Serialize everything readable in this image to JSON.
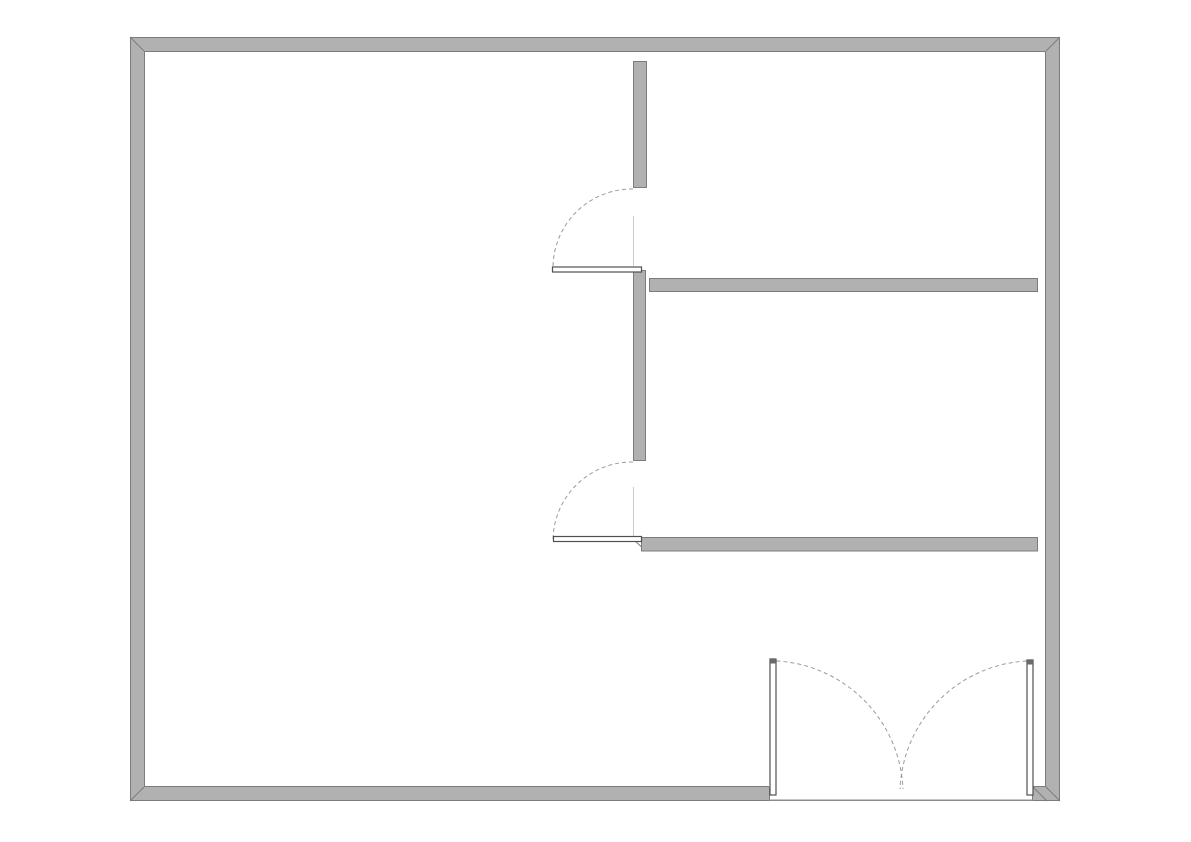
{
  "meta": {
    "canvas": {
      "width": 1191,
      "height": 842
    },
    "background": "#ffffff"
  },
  "palette": {
    "wall_fill": "#b1b1b1",
    "wall_outline": "#7c7c7c",
    "door_leaf_fill": "#ffffff",
    "door_leaf_stroke": "#4f4f4f",
    "door_leaf_cap": "#6a6a6a",
    "swing_arc": "#9b9b9b",
    "axis_line": "#cacaca",
    "threshold": "#8c8c8c"
  },
  "plan": {
    "layers": [
      {
        "group": "outer-wall-fills",
        "shape": "rect",
        "crisp": true,
        "style": {
          "fill": "wall_fill"
        },
        "items": [
          {
            "name": "outer-wall-top",
            "x": 130,
            "y": 37,
            "w": 930,
            "h": 14
          },
          {
            "name": "outer-wall-left",
            "x": 130,
            "y": 37,
            "w": 14,
            "h": 764
          },
          {
            "name": "outer-wall-right",
            "x": 1046,
            "y": 37,
            "w": 14,
            "h": 764
          },
          {
            "name": "outer-wall-bottom-left",
            "x": 130,
            "y": 787,
            "w": 639,
            "h": 14
          },
          {
            "name": "outer-wall-bottom-right",
            "x": 1033,
            "y": 787,
            "w": 27,
            "h": 14
          }
        ]
      },
      {
        "group": "outer-wall-outline",
        "shape": "rect",
        "crisp": true,
        "style": {
          "stroke": "wall_outline",
          "width": 1
        },
        "items": [
          {
            "name": "outer-wall-outer-contour",
            "x": 130.5,
            "y": 37.5,
            "w": 929,
            "h": 763
          }
        ]
      },
      {
        "group": "outer-wall-inner-edges",
        "shape": "line",
        "crisp": true,
        "style": {
          "stroke": "wall_outline",
          "width": 1
        },
        "items": [
          {
            "name": "inner-edge-top",
            "x1": 144,
            "y1": 51.5,
            "x2": 1046,
            "y2": 51.5
          },
          {
            "name": "inner-edge-left",
            "x1": 144.5,
            "y1": 51,
            "x2": 144.5,
            "y2": 787
          },
          {
            "name": "inner-edge-right",
            "x1": 1045.5,
            "y1": 51,
            "x2": 1045.5,
            "y2": 787
          },
          {
            "name": "inner-edge-bottom-left",
            "x1": 144,
            "y1": 786.5,
            "x2": 769,
            "y2": 786.5
          },
          {
            "name": "inner-edge-bottom-right",
            "x1": 1033,
            "y1": 786.5,
            "x2": 1046,
            "y2": 786.5
          },
          {
            "name": "entry-jamb-left",
            "x1": 769.5,
            "y1": 787,
            "x2": 769.5,
            "y2": 800
          },
          {
            "name": "entry-jamb-right",
            "x1": 1032.5,
            "y1": 787,
            "x2": 1032.5,
            "y2": 800
          }
        ]
      },
      {
        "group": "corner-miters",
        "shape": "line",
        "crisp": false,
        "style": {
          "stroke": "wall_outline",
          "width": 1
        },
        "items": [
          {
            "name": "miter-top-left",
            "x1": 130,
            "y1": 37,
            "x2": 144,
            "y2": 51
          },
          {
            "name": "miter-top-right",
            "x1": 1060,
            "y1": 37,
            "x2": 1046,
            "y2": 51
          },
          {
            "name": "miter-bottom-left",
            "x1": 130,
            "y1": 801,
            "x2": 144,
            "y2": 787
          },
          {
            "name": "miter-bottom-right",
            "x1": 1060,
            "y1": 801,
            "x2": 1046,
            "y2": 787
          },
          {
            "name": "miter-entry-right-jamb",
            "x1": 1033,
            "y1": 787,
            "x2": 1047,
            "y2": 801
          },
          {
            "name": "miter-hall-wall-lower-left",
            "x1": 634,
            "y1": 540,
            "x2": 646,
            "y2": 551
          }
        ]
      },
      {
        "group": "interior-walls",
        "shape": "rect",
        "crisp": true,
        "style": {
          "fill": "wall_fill",
          "stroke": "wall_outline",
          "width": 1
        },
        "items": [
          {
            "name": "partition-wall-upper",
            "x": 633.5,
            "y": 61.5,
            "w": 13,
            "h": 126
          },
          {
            "name": "partition-wall-middle",
            "x": 633.5,
            "y": 270.5,
            "w": 12,
            "h": 190
          },
          {
            "name": "hall-wall-upper",
            "x": 649.5,
            "y": 278.5,
            "w": 388,
            "h": 13
          },
          {
            "name": "hall-wall-lower",
            "x": 641.5,
            "y": 537.5,
            "w": 396,
            "h": 13.5
          }
        ]
      },
      {
        "group": "door-axis-lines",
        "shape": "line",
        "crisp": true,
        "style": {
          "stroke": "axis_line",
          "width": 1
        },
        "items": [
          {
            "name": "door-1-axis-line",
            "x1": 633.5,
            "y1": 216,
            "x2": 633.5,
            "y2": 266
          },
          {
            "name": "door-2-axis-line",
            "x1": 633.5,
            "y1": 487,
            "x2": 633.5,
            "y2": 536
          }
        ]
      },
      {
        "group": "door-swing-arcs",
        "shape": "path",
        "crisp": false,
        "style": {
          "stroke": "swing_arc",
          "width": 1,
          "dash": "4 3"
        },
        "items": [
          {
            "name": "door-1-swing-arc",
            "d": "M633,189 A79,79 0 0 0 553,268"
          },
          {
            "name": "door-2-swing-arc",
            "d": "M633,462 A79,79 0 0 0 553,541"
          },
          {
            "name": "entry-door-left-swing-arc",
            "d": "M776.5,661 A134,134 0 0 1 903,789"
          },
          {
            "name": "entry-door-right-swing-arc",
            "d": "M1026.5,661 A134,134 0 0 0 900,789"
          }
        ]
      },
      {
        "group": "door-leaves",
        "shape": "rect",
        "crisp": false,
        "style": {
          "fill": "door_leaf_fill",
          "stroke": "door_leaf_stroke",
          "width": 1.2
        },
        "items": [
          {
            "name": "door-1-leaf",
            "x": 552.5,
            "y": 267,
            "w": 89,
            "h": 5
          },
          {
            "name": "door-2-leaf",
            "x": 553.5,
            "y": 536.5,
            "w": 88,
            "h": 5
          },
          {
            "name": "entry-door-left-leaf",
            "x": 770,
            "y": 659,
            "w": 6,
            "h": 136
          },
          {
            "name": "entry-door-right-leaf",
            "x": 1027,
            "y": 660,
            "w": 6,
            "h": 135
          }
        ]
      },
      {
        "group": "door-leaf-caps",
        "shape": "rect",
        "crisp": true,
        "style": {
          "fill": "door_leaf_cap"
        },
        "items": [
          {
            "name": "entry-door-left-leaf-cap",
            "x": 770,
            "y": 659,
            "w": 6,
            "h": 4.5
          },
          {
            "name": "entry-door-right-leaf-cap",
            "x": 1027,
            "y": 660,
            "w": 6,
            "h": 4.5
          }
        ]
      },
      {
        "group": "entry-threshold",
        "shape": "line",
        "crisp": true,
        "style": {
          "stroke": "threshold",
          "width": 1.6
        },
        "items": [
          {
            "name": "entry-threshold-line",
            "x1": 769,
            "y1": 800.3,
            "x2": 1033,
            "y2": 800.3
          }
        ]
      }
    ]
  }
}
